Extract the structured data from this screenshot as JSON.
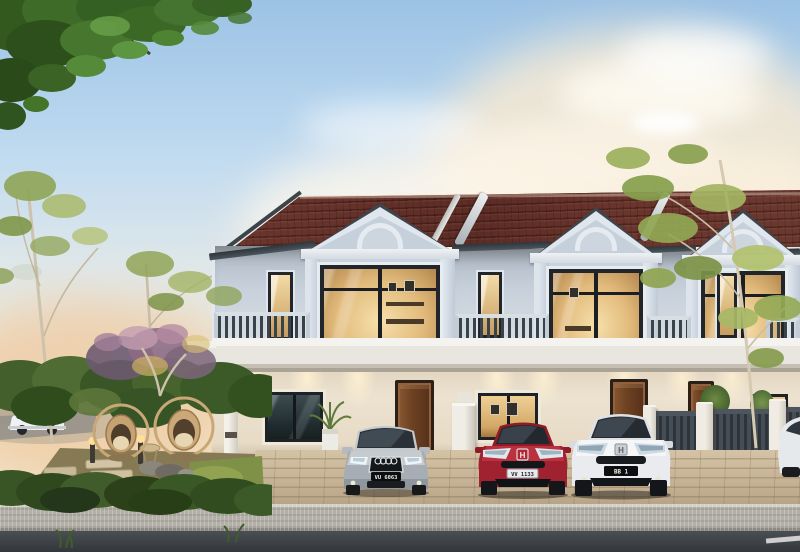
{
  "scene": {
    "type": "architectural exterior rendering at dusk",
    "subject": "double-storey terrace house row with landscaped garden, driveway and street"
  },
  "houses": {
    "units_visible": 3,
    "roof": "terracotta tile roof with solar water heaters and party-wall copings",
    "upper_facade": "light blue-grey gables with arched pediments, full-height windows and slatted balcony railings",
    "lower_facade": "cream wall with warm downlights, timber doors and dark-framed windows",
    "fence": "white pillars with dark slat infill"
  },
  "cars": [
    {
      "name": "silver-sedan",
      "body_color": "#b6bcc2",
      "plate": "VU 6063"
    },
    {
      "name": "red-coupe",
      "body_color": "#9e2130",
      "plate": "VV 1133"
    },
    {
      "name": "white-coupe",
      "body_color": "#e9ebee",
      "plate": "BB 1"
    },
    {
      "name": "street-white-car",
      "body_color": "#edeff1",
      "plate": ""
    },
    {
      "name": "edge-white-car",
      "body_color": "#e6e9ec",
      "plate": ""
    }
  ],
  "garden": {
    "elements": [
      "hanging egg chairs",
      "stepping stones",
      "bollard lights",
      "boulders",
      "clipped hedge",
      "slender trees",
      "flowering shrub",
      "side table"
    ]
  },
  "street": {
    "surfaces": [
      "brick paver driveway",
      "textured concrete apron",
      "asphalt road"
    ],
    "marking_color": "#e8e8e4"
  },
  "palette": {
    "sky_top": "#9cc2e4",
    "sky_horizon": "#f3e3c6",
    "roof": "#62302a",
    "upper_wall": "#c8d1db",
    "trim": "#e6ebf1",
    "lower_wall": "#ece2d0",
    "door": "#6e4223",
    "window_glow": "#f0d49b",
    "railing": "#39434c",
    "hedge": "#3b5226",
    "paver": "#c4b092",
    "asphalt": "#3a3f44"
  }
}
